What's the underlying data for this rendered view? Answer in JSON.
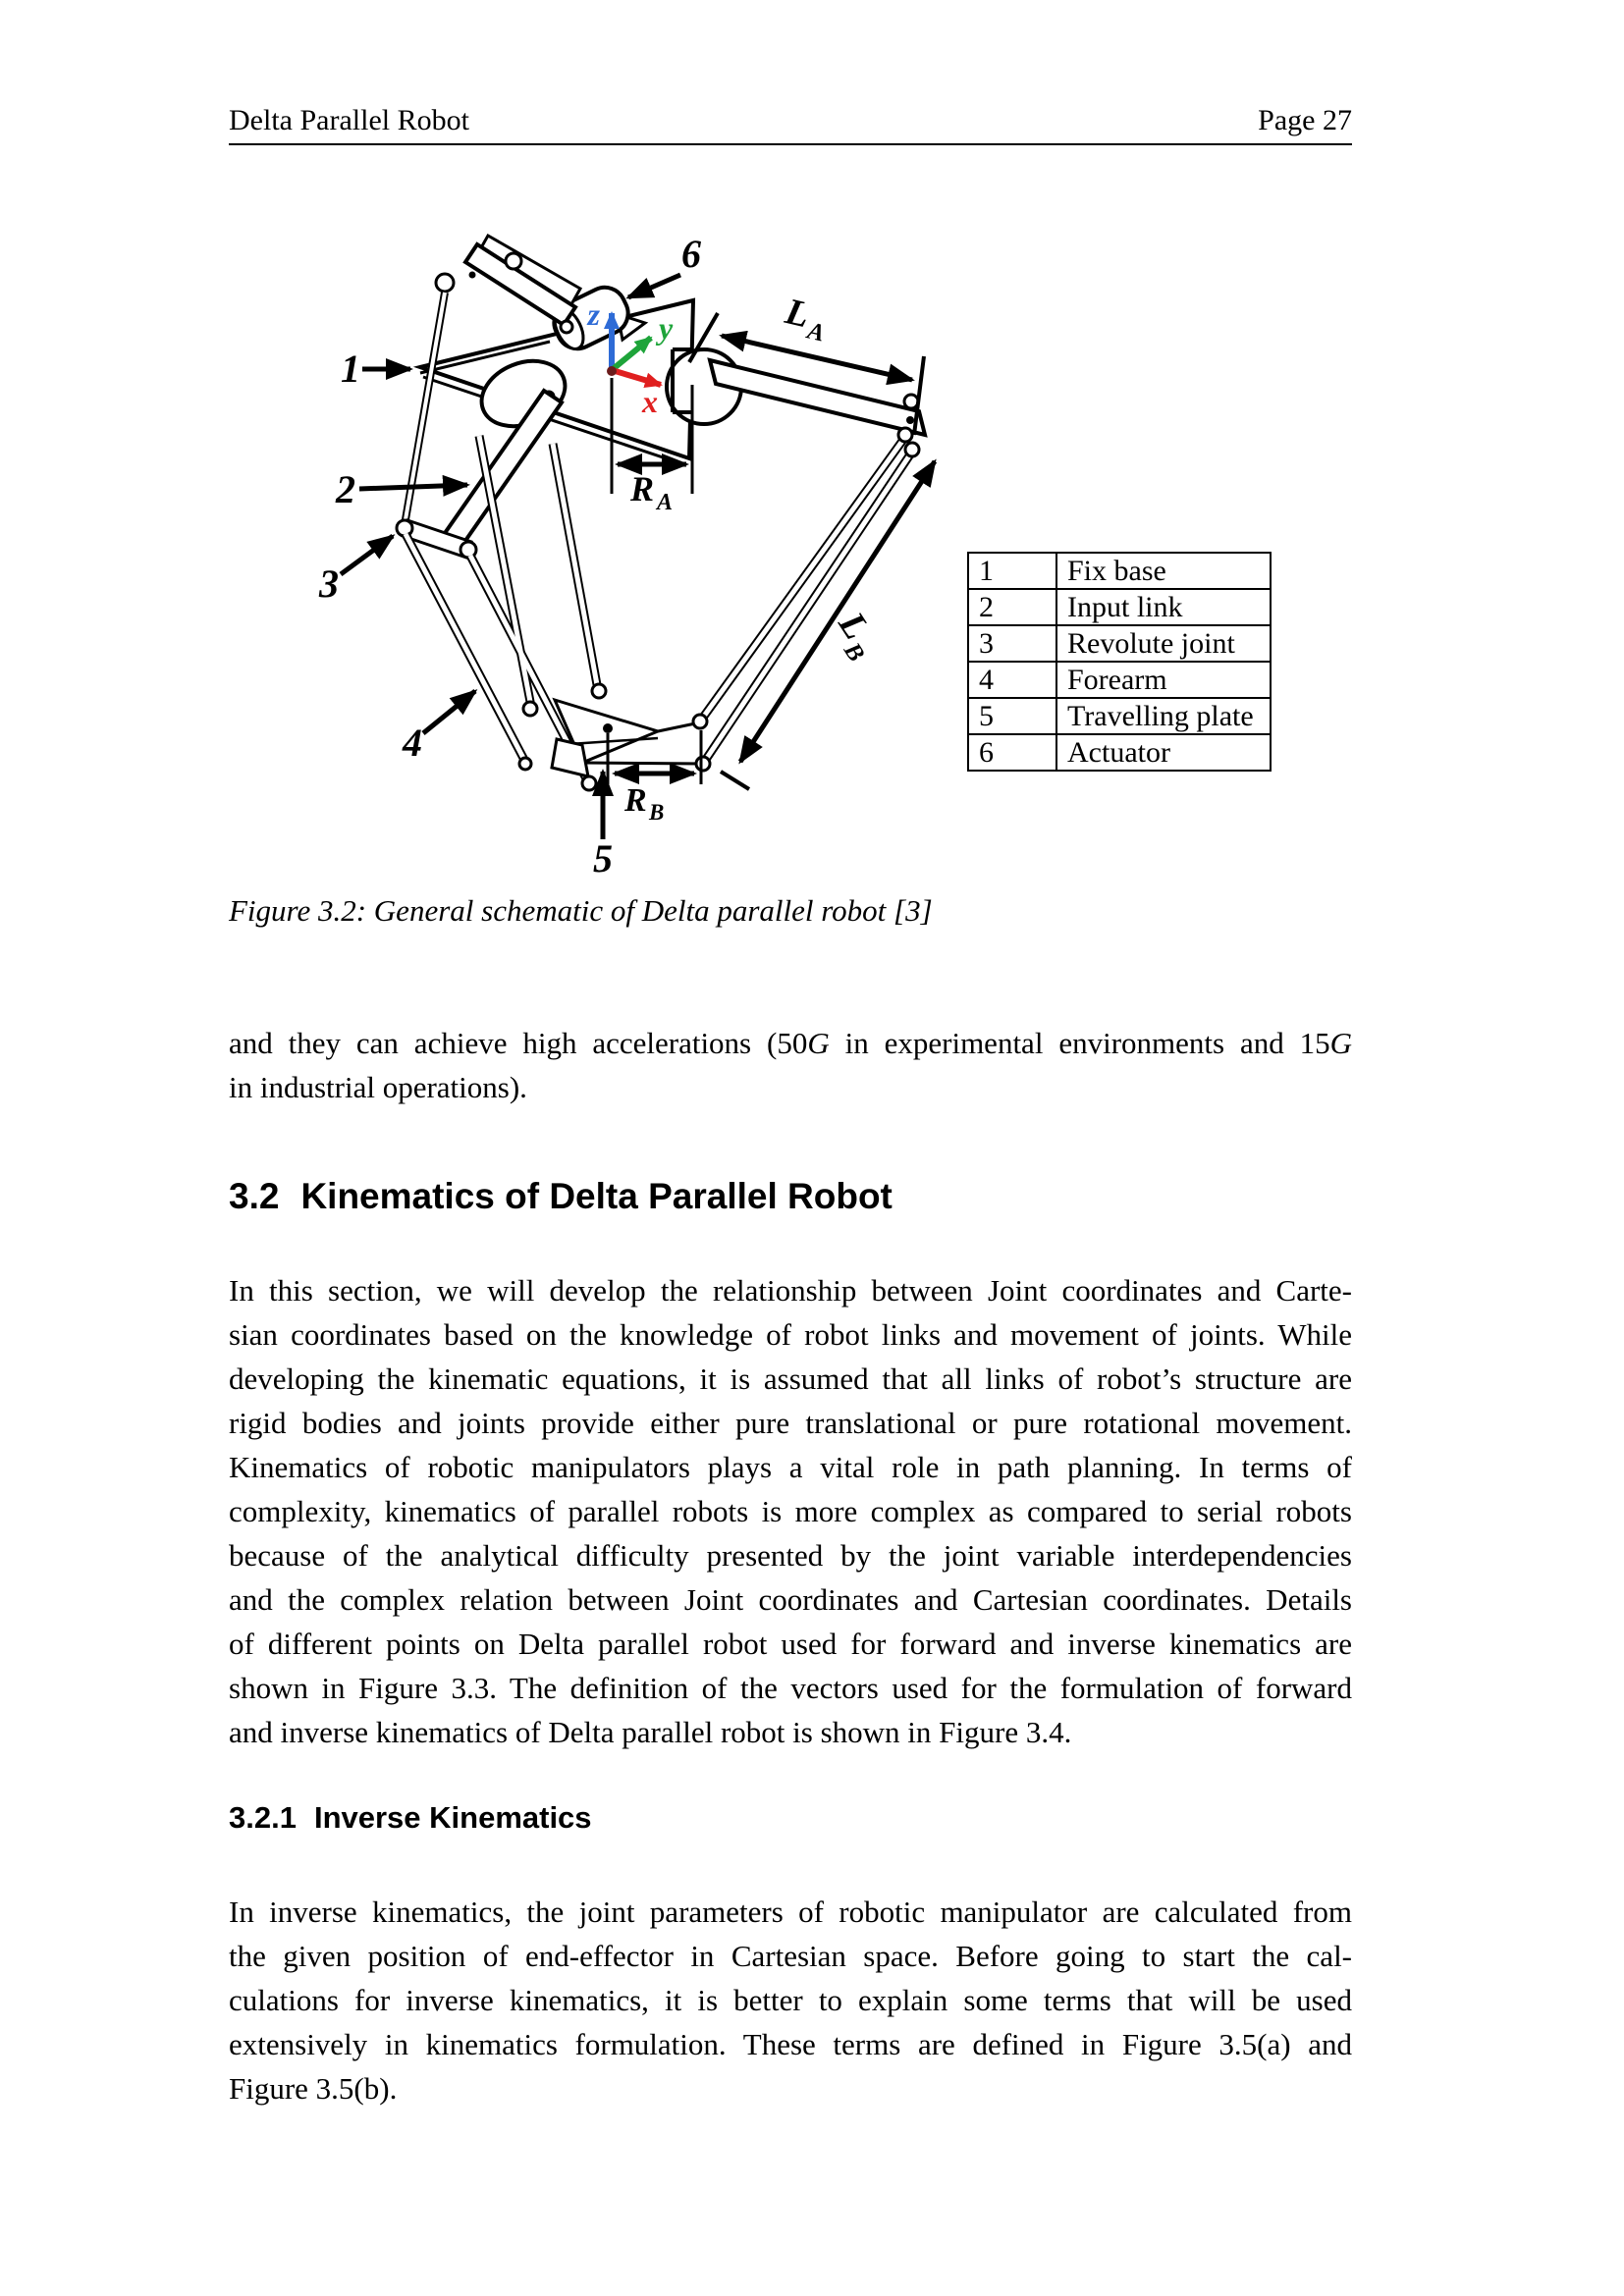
{
  "header": {
    "left": "Delta Parallel Robot",
    "right": "Page 27"
  },
  "figure": {
    "caption": "Figure 3.2: General schematic of Delta parallel robot [3]",
    "axes": {
      "x": "x",
      "y": "y",
      "z": "z"
    },
    "axis_colors": {
      "x": "#e01f1f",
      "y": "#1ea43a",
      "z": "#2e6bd6"
    },
    "dims": {
      "la": {
        "main": "L",
        "sub": "A"
      },
      "lb": {
        "main": "L",
        "sub": "B"
      },
      "ra": {
        "main": "R",
        "sub": "A"
      },
      "rb": {
        "main": "R",
        "sub": "B"
      }
    },
    "parts": [
      "1",
      "2",
      "3",
      "4",
      "5",
      "6"
    ],
    "legend": {
      "rows": [
        {
          "num": "1",
          "name": "Fix base"
        },
        {
          "num": "2",
          "name": "Input link"
        },
        {
          "num": "3",
          "name": "Revolute joint"
        },
        {
          "num": "4",
          "name": "Forearm"
        },
        {
          "num": "5",
          "name": "Travelling plate"
        },
        {
          "num": "6",
          "name": "Actuator"
        }
      ]
    }
  },
  "para1": {
    "seg1": "and they can achieve high accelerations (50",
    "g1": "G",
    "seg2": " in experimental environments and 15",
    "g2": "G",
    "line2": "in industrial operations)."
  },
  "heading32": {
    "num": "3.2",
    "title": "Kinematics of Delta Parallel Robot"
  },
  "para2": {
    "lines": [
      "In this section, we will develop the relationship between Joint coordinates and Carte-",
      "sian coordinates based on the knowledge of robot links and movement of joints. While",
      "developing the kinematic equations, it is assumed that all links of robot’s structure are",
      "rigid bodies and joints provide either pure translational or pure rotational movement.",
      "Kinematics of robotic manipulators plays a vital role in path planning. In terms of",
      "complexity, kinematics of parallel robots is more complex as compared to serial robots",
      "because of the analytical difficulty presented by the joint variable interdependencies",
      "and the complex relation between Joint coordinates and Cartesian coordinates. Details",
      "of different points on Delta parallel robot used for forward and inverse kinematics are",
      "shown in Figure 3.3. The definition of the vectors used for the formulation of forward",
      "and inverse kinematics of Delta parallel robot is shown in Figure 3.4."
    ]
  },
  "heading321": {
    "num": "3.2.1",
    "title": "Inverse Kinematics"
  },
  "para3": {
    "lines": [
      "In inverse kinematics, the joint parameters of robotic manipulator are calculated from",
      "the given position of end-effector in Cartesian space. Before going to start the cal-",
      "culations for inverse kinematics, it is better to explain some terms that will be used",
      "extensively in kinematics formulation. These terms are defined in Figure 3.5(a) and",
      "Figure 3.5(b)."
    ]
  }
}
